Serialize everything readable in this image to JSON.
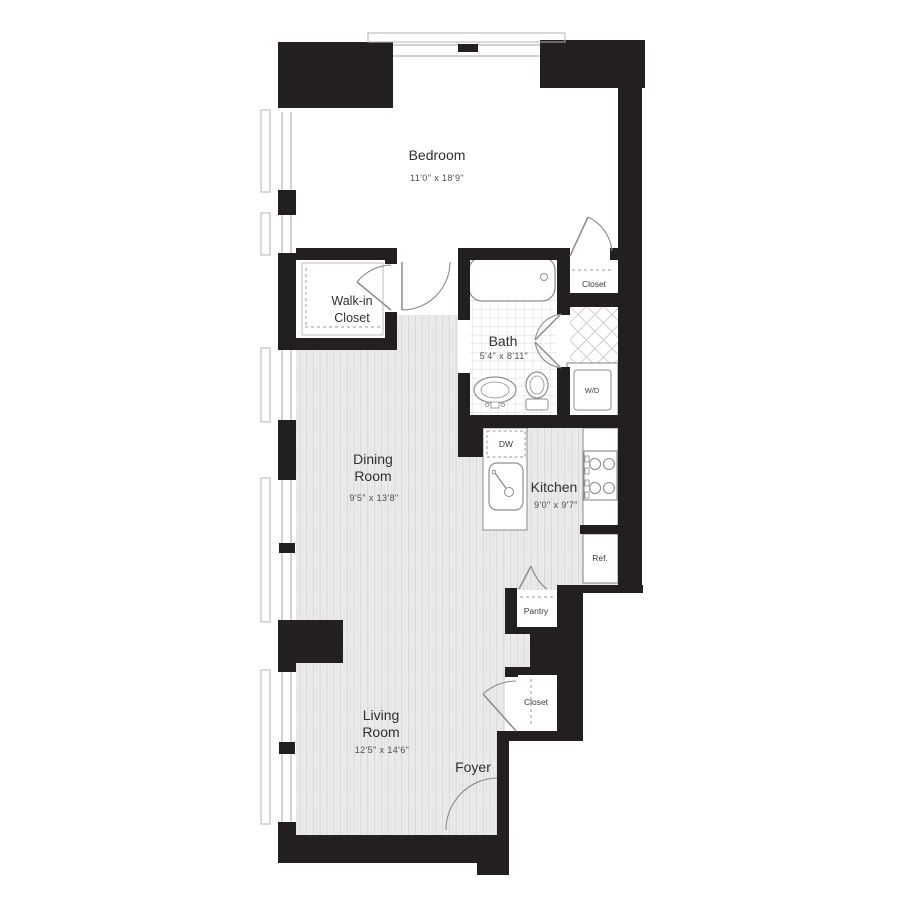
{
  "plan": {
    "type": "apartment-floor-plan",
    "rooms": {
      "bedroom": {
        "name": "Bedroom",
        "dims": "11'0\" x 18'9\""
      },
      "walk_in_closet": {
        "line1": "Walk-in",
        "line2": "Closet"
      },
      "bath": {
        "name": "Bath",
        "dims": "5'4\" x 8'11\""
      },
      "bedroom_closet": {
        "name": "Closet"
      },
      "laundry": {
        "name": "W/D"
      },
      "kitchen": {
        "name": "Kitchen",
        "dims": "9'0\" x 9'7\"",
        "dishwasher": "DW",
        "refrigerator": "Ref."
      },
      "pantry": {
        "name": "Pantry"
      },
      "dining": {
        "line1": "Dining",
        "line2": "Room",
        "dims": "9'5\" x 13'8\""
      },
      "living": {
        "line1": "Living",
        "line2": "Room",
        "dims": "12'5\" x 14'6\""
      },
      "foyer": {
        "name": "Foyer"
      },
      "entry_closet": {
        "name": "Closet"
      }
    },
    "colors": {
      "wall": "#231f20",
      "floor_bg": "#ebebeb",
      "floor_stripe": "#d7d7d7",
      "tile_line": "#d9d9d9",
      "diamond_line": "#cbcbcb",
      "fixture_line": "#8e8e8e",
      "window_line": "#a6a6a6",
      "label_text": "#2f2f2f",
      "dim_text": "#4d4d4d"
    }
  }
}
